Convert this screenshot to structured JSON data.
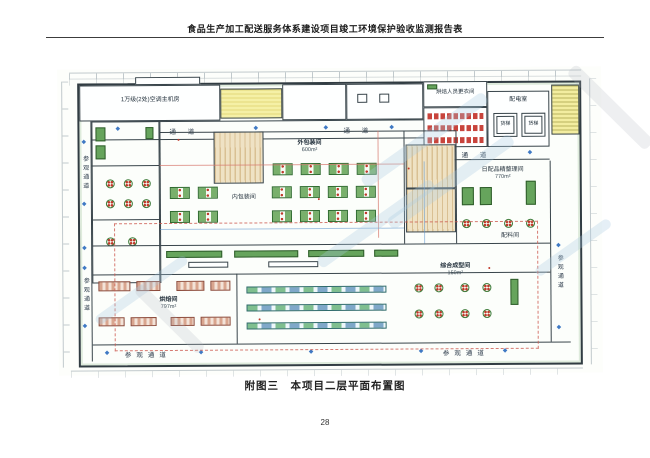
{
  "page": {
    "header_title": "食品生产加工配送服务体系建设项目竣工环境保护验收监测报告表",
    "caption": "附图三　本项目二层平面布置图",
    "page_number": "28"
  },
  "plan": {
    "marker_glyph": "◆",
    "corridor_labels": {
      "top_1": "通 道",
      "top_2": "通 道",
      "right_top": "通 道",
      "left_upper": "参观通道",
      "left_lower": "参观通道",
      "right_side": "参观通道",
      "bottom_left": "参观通道",
      "bottom_right": "参观通道"
    },
    "rooms": {
      "hvac": "1万级(2处)空调主机房",
      "changing": "烘焙人员更衣间",
      "power": "配电室",
      "lift": "货梯",
      "outer_packing": "外包装间",
      "outer_packing_area": "600m²",
      "inner_packing": "内包装间",
      "daily_sorting": "日配品精整理间",
      "daily_sorting_area": "770m²",
      "ingredient": "配料间",
      "baking": "烘焙间",
      "baking_area": "797m²",
      "forming": "综合成型间",
      "forming_area": "150m²"
    }
  }
}
